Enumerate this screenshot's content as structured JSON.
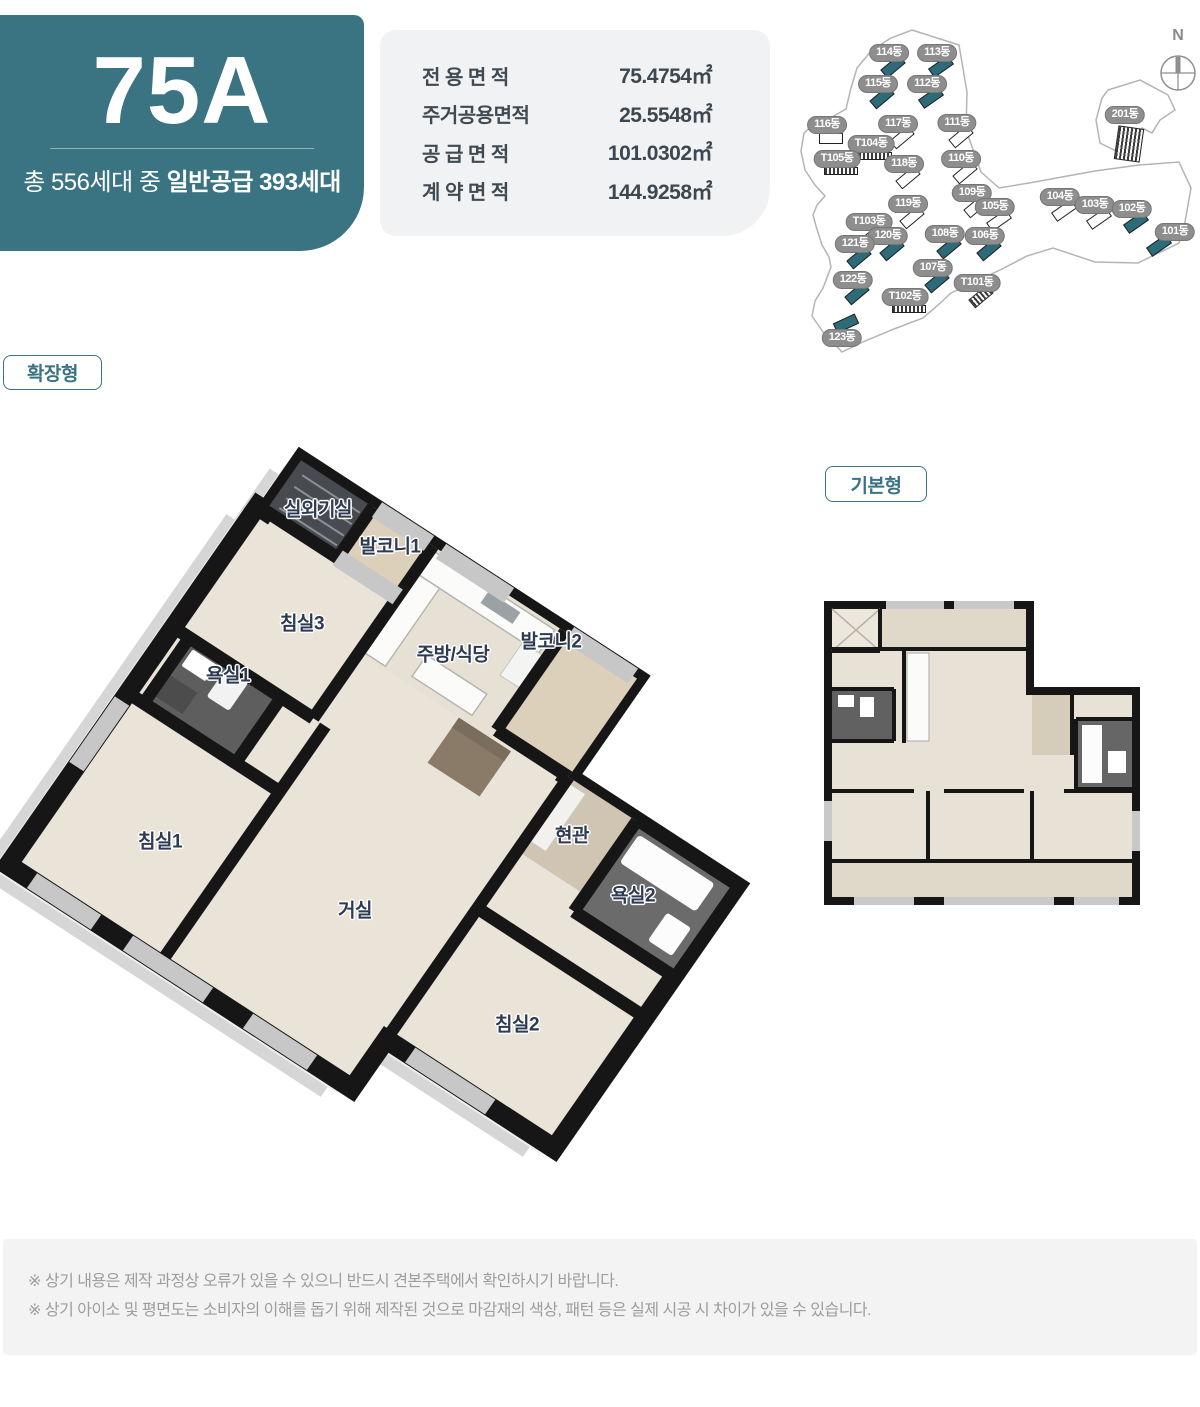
{
  "header": {
    "unit_code": "75A",
    "subtitle_prefix": "총 556세대 중 ",
    "subtitle_strong": "일반공급 393세대",
    "accent_color": "#3a7381"
  },
  "specs": {
    "rows": [
      {
        "label": "전 용 면 적",
        "value": "75.4754㎡"
      },
      {
        "label": "주거공용면적",
        "value": "25.5548㎡"
      },
      {
        "label": "공 급 면 적",
        "value": "101.0302㎡"
      },
      {
        "label": "계 약 면 적",
        "value": "144.9258㎡"
      }
    ]
  },
  "sitemap": {
    "compass_label": "N",
    "buildings": [
      {
        "label": "114동",
        "x": 94,
        "y": 38,
        "v": "t",
        "r": -40
      },
      {
        "label": "113동",
        "x": 142,
        "y": 38,
        "v": "t",
        "r": -35
      },
      {
        "label": "115동",
        "x": 83,
        "y": 69,
        "v": "t",
        "r": -40
      },
      {
        "label": "112동",
        "x": 132,
        "y": 69,
        "v": "t",
        "r": -35
      },
      {
        "label": "116동",
        "x": 32,
        "y": 110,
        "v": "w",
        "r": 0
      },
      {
        "label": "117동",
        "x": 103,
        "y": 109,
        "v": "w",
        "r": -40
      },
      {
        "label": "111동",
        "x": 162,
        "y": 108,
        "v": "w",
        "r": -40
      },
      {
        "label": "T104동",
        "x": 76,
        "y": 129,
        "v": "d",
        "r": 0,
        "gw": 34,
        "gh": 8
      },
      {
        "label": "T105동",
        "x": 42,
        "y": 144,
        "v": "d",
        "r": 0,
        "gw": 34,
        "gh": 8
      },
      {
        "label": "118동",
        "x": 109,
        "y": 149,
        "v": "w",
        "r": -40
      },
      {
        "label": "110동",
        "x": 166,
        "y": 144,
        "v": "w",
        "r": -40
      },
      {
        "label": "109동",
        "x": 177,
        "y": 178,
        "v": "w",
        "r": -40
      },
      {
        "label": "119동",
        "x": 113,
        "y": 189,
        "v": "w",
        "r": -40
      },
      {
        "label": "105동",
        "x": 200,
        "y": 192,
        "v": "w",
        "r": -35
      },
      {
        "label": "104동",
        "x": 265,
        "y": 182,
        "v": "w",
        "r": -35
      },
      {
        "label": "103동",
        "x": 300,
        "y": 190,
        "v": "w",
        "r": -35
      },
      {
        "label": "102동",
        "x": 337,
        "y": 194,
        "v": "t",
        "r": -35
      },
      {
        "label": "101동",
        "x": 380,
        "y": 217,
        "v": "t",
        "r": -35,
        "dx": -16
      },
      {
        "label": "T103동",
        "x": 74,
        "y": 207,
        "v": "d",
        "r": -40
      },
      {
        "label": "120동",
        "x": 93,
        "y": 221,
        "v": "t",
        "r": -40
      },
      {
        "label": "121동",
        "x": 60,
        "y": 229,
        "v": "t",
        "r": -40
      },
      {
        "label": "108동",
        "x": 150,
        "y": 219,
        "v": "t",
        "r": -40
      },
      {
        "label": "106동",
        "x": 190,
        "y": 221,
        "v": "t",
        "r": -40
      },
      {
        "label": "107동",
        "x": 138,
        "y": 253,
        "v": "t",
        "r": -40
      },
      {
        "label": "T101동",
        "x": 182,
        "y": 268,
        "v": "d",
        "r": -40
      },
      {
        "label": "122동",
        "x": 58,
        "y": 265,
        "v": "t",
        "r": -40
      },
      {
        "label": "T102동",
        "x": 110,
        "y": 282,
        "v": "d",
        "r": 0,
        "gw": 34,
        "gh": 8
      },
      {
        "label": "123동",
        "x": 47,
        "y": 323,
        "v": "t",
        "r": -25,
        "dy": -28
      },
      {
        "label": "201동",
        "x": 330,
        "y": 100,
        "v": "d",
        "r": 8,
        "gw": 26,
        "gh": 34,
        "dy": 4
      }
    ]
  },
  "plans": {
    "expanded_badge": "확장형",
    "basic_badge": "기본형",
    "iso_labels": [
      {
        "text": "실외기실",
        "x": 318,
        "y": 508
      },
      {
        "text": "발코니1",
        "x": 390,
        "y": 545
      },
      {
        "text": "침실3",
        "x": 302,
        "y": 622
      },
      {
        "text": "주방/식당",
        "x": 453,
        "y": 653
      },
      {
        "text": "발코니2",
        "x": 551,
        "y": 640
      },
      {
        "text": "욕실1",
        "x": 228,
        "y": 674
      },
      {
        "text": "침실1",
        "x": 160,
        "y": 840
      },
      {
        "text": "거실",
        "x": 355,
        "y": 909
      },
      {
        "text": "현관",
        "x": 572,
        "y": 834
      },
      {
        "text": "욕실2",
        "x": 633,
        "y": 894
      },
      {
        "text": "침실2",
        "x": 517,
        "y": 1023
      }
    ]
  },
  "footnotes": [
    "※ 상기 내용은 제작 과정상 오류가 있을 수 있으니 반드시 견본주택에서 확인하시기 바랍니다.",
    "※ 상기 아이소 및 평면도는 소비자의 이해를 돕기 위해 제작된 것으로 마감재의 색상, 패턴 등은 실제 시공 시 차이가 있을 수 있습니다."
  ]
}
